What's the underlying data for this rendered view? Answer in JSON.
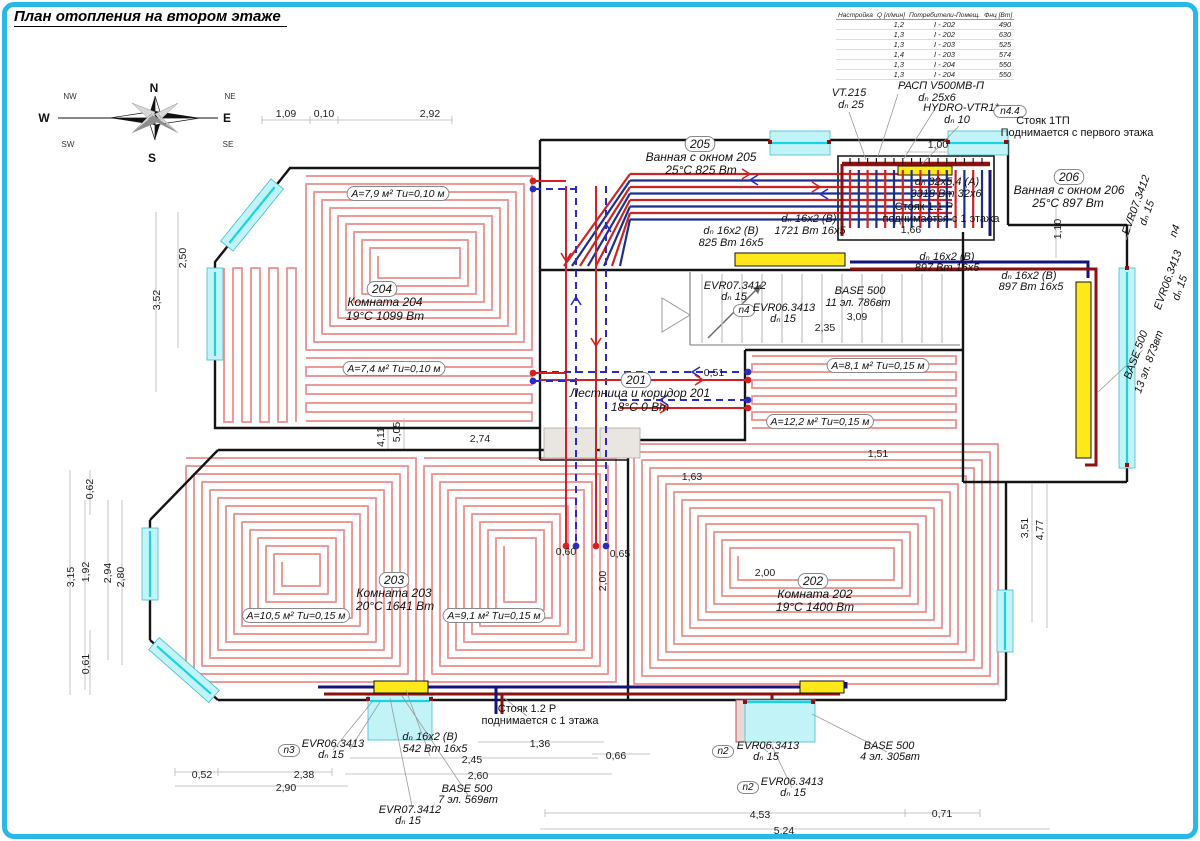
{
  "title": "План отопления на втором этаже",
  "compass": {
    "n": "N",
    "ne": "NE",
    "e": "E",
    "se": "SE",
    "s": "S",
    "sw": "SW",
    "w": "W",
    "nw": "NW"
  },
  "colors": {
    "frame": "#29b8ea",
    "loop": "#ef9a9a",
    "supply": "#d42020",
    "return": "#2b2bc0",
    "pipe_hot": "#8f1010",
    "pipe_cold": "#14147a",
    "window": "#c2f3f7",
    "radiator": "#ffe81a"
  },
  "table": {
    "headers": [
      "Настройка",
      "Q [л/мин]",
      "Потребители-Помещ.",
      "Фнц [Вт]"
    ],
    "rows": [
      [
        "",
        "1,2",
        "I - 202",
        "490"
      ],
      [
        "",
        "1,3",
        "I - 202",
        "630"
      ],
      [
        "",
        "1,3",
        "I - 203",
        "525"
      ],
      [
        "",
        "1,4",
        "I - 203",
        "574"
      ],
      [
        "",
        "1,3",
        "I - 204",
        "550"
      ],
      [
        "",
        "1,3",
        "I - 204",
        "550"
      ]
    ]
  },
  "rooms": [
    {
      "number": "204",
      "name": "Комната 204",
      "climate": "19°C 1099 Вт"
    },
    {
      "number": "205",
      "name": "Ванная с окном 205",
      "climate": "25°C 825 Вт"
    },
    {
      "number": "206",
      "name": "Ванная с окном 206",
      "climate": "25°C 897 Вт"
    },
    {
      "number": "201",
      "name": "Лестница и коридор 201",
      "climate": "18°C 0 Вт"
    },
    {
      "number": "202",
      "name": "Комната 202",
      "climate": "19°C 1400 Вт"
    },
    {
      "number": "203",
      "name": "Комната 203",
      "climate": "20°C 1641 Вт"
    }
  ],
  "plan": {
    "labels": [
      {
        "t": "1,09",
        "c": "d",
        "x": 286,
        "y": 117
      },
      {
        "t": "0,10",
        "c": "d",
        "x": 324,
        "y": 117
      },
      {
        "t": "2,92",
        "c": "d",
        "x": 430,
        "y": 117
      },
      {
        "t": "1,00",
        "c": "d",
        "x": 938,
        "y": 148
      },
      {
        "t": "2,74",
        "c": "d",
        "x": 480,
        "y": 442
      },
      {
        "t": "4,11",
        "c": "dr",
        "x": 384,
        "y": 437,
        "r": -90
      },
      {
        "t": "5,05",
        "c": "dr",
        "x": 400,
        "y": 432,
        "r": -90
      },
      {
        "t": "2,50",
        "c": "dr",
        "x": 186,
        "y": 258,
        "r": -90
      },
      {
        "t": "3,52",
        "c": "dr",
        "x": 160,
        "y": 300,
        "r": -90
      },
      {
        "t": "0,62",
        "c": "dr",
        "x": 93,
        "y": 489,
        "r": -90
      },
      {
        "t": "3,15",
        "c": "dr",
        "x": 74,
        "y": 577,
        "r": -90
      },
      {
        "t": "1,92",
        "c": "dr",
        "x": 89,
        "y": 572,
        "r": -90
      },
      {
        "t": "2,94",
        "c": "dr",
        "x": 111,
        "y": 573,
        "r": -90
      },
      {
        "t": "2,80",
        "c": "dr",
        "x": 124,
        "y": 577,
        "r": -90
      },
      {
        "t": "0,61",
        "c": "dr",
        "x": 89,
        "y": 664,
        "r": -90
      },
      {
        "t": "3,51",
        "c": "dr",
        "x": 1028,
        "y": 528,
        "r": -90
      },
      {
        "t": "4,77",
        "c": "dr",
        "x": 1043,
        "y": 530,
        "r": -90
      },
      {
        "t": "1,10",
        "c": "dr",
        "x": 1061,
        "y": 229,
        "r": -90
      },
      {
        "t": "1,66",
        "c": "d",
        "x": 911,
        "y": 233
      },
      {
        "t": "2,35",
        "c": "d",
        "x": 825,
        "y": 331
      },
      {
        "t": "3,09",
        "c": "d",
        "x": 857,
        "y": 320
      },
      {
        "t": "0,51",
        "c": "d",
        "x": 714,
        "y": 376
      },
      {
        "t": "1,63",
        "c": "d",
        "x": 692,
        "y": 480
      },
      {
        "t": "0,60",
        "c": "d",
        "x": 566,
        "y": 555
      },
      {
        "t": "0,65",
        "c": "d",
        "x": 620,
        "y": 557
      },
      {
        "t": "2,00",
        "c": "dr",
        "x": 606,
        "y": 581,
        "r": -90
      },
      {
        "t": "2,00",
        "c": "d",
        "x": 765,
        "y": 576
      },
      {
        "t": "1,51",
        "c": "d",
        "x": 878,
        "y": 457
      },
      {
        "t": "0,52",
        "c": "d",
        "x": 202,
        "y": 778
      },
      {
        "t": "2,38",
        "c": "d",
        "x": 304,
        "y": 778
      },
      {
        "t": "2,90",
        "c": "d",
        "x": 286,
        "y": 791
      },
      {
        "t": "1,36",
        "c": "d",
        "x": 540,
        "y": 747
      },
      {
        "t": "0,66",
        "c": "d",
        "x": 616,
        "y": 759
      },
      {
        "t": "2,45",
        "c": "d",
        "x": 472,
        "y": 763
      },
      {
        "t": "2,60",
        "c": "d",
        "x": 478,
        "y": 779
      },
      {
        "t": "4,53",
        "c": "d",
        "x": 760,
        "y": 818
      },
      {
        "t": "0,71",
        "c": "d",
        "x": 942,
        "y": 817
      },
      {
        "t": "5,24",
        "c": "d",
        "x": 784,
        "y": 834
      },
      {
        "t": "VT.215",
        "c": "l",
        "x": 849,
        "y": 96
      },
      {
        "t": "dₙ 25",
        "c": "l",
        "x": 851,
        "y": 108
      },
      {
        "t": "РАСП V500МВ-П",
        "c": "l",
        "x": 941,
        "y": 89
      },
      {
        "t": "dₙ 25x6",
        "c": "l",
        "x": 937,
        "y": 101
      },
      {
        "t": "HYDRO-VTR1*",
        "c": "l",
        "x": 961,
        "y": 111
      },
      {
        "t": "dₙ 10",
        "c": "l",
        "x": 957,
        "y": 123
      },
      {
        "t": "n4.4",
        "c": "n",
        "x": 1010,
        "y": 114,
        "b": 1
      },
      {
        "t": "Стояк 1ТП",
        "c": "s",
        "x": 1043,
        "y": 124
      },
      {
        "t": "Поднимается с первого этажа",
        "c": "s",
        "x": 1077,
        "y": 136
      },
      {
        "t": "dₙ 32x5,4 (А)",
        "c": "l",
        "x": 947,
        "y": 185
      },
      {
        "t": "3318 Вт 32x6",
        "c": "l",
        "x": 946,
        "y": 197
      },
      {
        "t": "Стояк 1.1 Р",
        "c": "s",
        "x": 924,
        "y": 210
      },
      {
        "t": "поднимается с 1 этажа",
        "c": "s",
        "x": 941,
        "y": 222
      },
      {
        "t": "dₙ 16x2 (В)",
        "c": "l",
        "x": 731,
        "y": 234
      },
      {
        "t": "825 Вт 16x5",
        "c": "l",
        "x": 731,
        "y": 246
      },
      {
        "t": "dₙ 16x2 (В)",
        "c": "l",
        "x": 809,
        "y": 222
      },
      {
        "t": "1721 Вт 16x5",
        "c": "l",
        "x": 810,
        "y": 234
      },
      {
        "t": "dₙ 16x2 (В)",
        "c": "l",
        "x": 947,
        "y": 260
      },
      {
        "t": "897 Вт 16x5",
        "c": "l",
        "x": 947,
        "y": 271
      },
      {
        "t": "dₙ 16x2 (В)",
        "c": "l",
        "x": 1029,
        "y": 279
      },
      {
        "t": "897 Вт 16x5",
        "c": "l",
        "x": 1031,
        "y": 290
      },
      {
        "t": "EVR07.3412",
        "c": "l",
        "x": 735,
        "y": 289
      },
      {
        "t": "dₙ 15",
        "c": "l",
        "x": 734,
        "y": 300
      },
      {
        "t": "n4",
        "c": "n",
        "x": 744,
        "y": 313,
        "b": 1
      },
      {
        "t": "EVR06.3413",
        "c": "l",
        "x": 784,
        "y": 311
      },
      {
        "t": "dₙ 15",
        "c": "l",
        "x": 783,
        "y": 322
      },
      {
        "t": "BASE 500",
        "c": "l",
        "x": 860,
        "y": 294
      },
      {
        "t": "11 эл. 786вт",
        "c": "l",
        "x": 858,
        "y": 306
      },
      {
        "t": "205",
        "c": "rn",
        "x": 700,
        "y": 148,
        "b": 1
      },
      {
        "t": "Ванная с окном 205",
        "c": "r",
        "x": 701,
        "y": 161
      },
      {
        "t": "25°C 825 Вт",
        "c": "r",
        "x": 701,
        "y": 174
      },
      {
        "t": "206",
        "c": "rn",
        "x": 1069,
        "y": 181,
        "b": 1
      },
      {
        "t": "Ванная с окном 206",
        "c": "r",
        "x": 1069,
        "y": 194
      },
      {
        "t": "25°C 897 Вт",
        "c": "r",
        "x": 1068,
        "y": 207
      },
      {
        "t": "204",
        "c": "rn",
        "x": 382,
        "y": 293,
        "b": 1
      },
      {
        "t": "Комната 204",
        "c": "r",
        "x": 385,
        "y": 306
      },
      {
        "t": "19°C 1099 Вт",
        "c": "r",
        "x": 385,
        "y": 320
      },
      {
        "t": "201",
        "c": "rn",
        "x": 636,
        "y": 384,
        "b": 1
      },
      {
        "t": "Лестница и коридор 201",
        "c": "r",
        "x": 640,
        "y": 397
      },
      {
        "t": "18°C 0 Вт",
        "c": "r",
        "x": 640,
        "y": 411
      },
      {
        "t": "202",
        "c": "rn",
        "x": 813,
        "y": 585,
        "b": 1
      },
      {
        "t": "Комната 202",
        "c": "r",
        "x": 815,
        "y": 598
      },
      {
        "t": "19°C 1400 Вт",
        "c": "r",
        "x": 815,
        "y": 611
      },
      {
        "t": "203",
        "c": "rn",
        "x": 394,
        "y": 584,
        "b": 1
      },
      {
        "t": "Комната 203",
        "c": "r",
        "x": 394,
        "y": 597
      },
      {
        "t": "20°C 1641 Вт",
        "c": "r",
        "x": 395,
        "y": 610
      },
      {
        "t": "А=7,9 м² Tи=0,10 м",
        "c": "a",
        "x": 398,
        "y": 197,
        "b": 1
      },
      {
        "t": "А=7,4 м² Tи=0,10 м",
        "c": "a",
        "x": 394,
        "y": 372,
        "b": 1
      },
      {
        "t": "А=10,5 м² Tи=0,15 м",
        "c": "a",
        "x": 296,
        "y": 619,
        "b": 1
      },
      {
        "t": "А=9,1 м² Tи=0,15 м",
        "c": "a",
        "x": 494,
        "y": 619,
        "b": 1
      },
      {
        "t": "А=8,1 м² Tи=0,15 м",
        "c": "a",
        "x": 878,
        "y": 369,
        "b": 1
      },
      {
        "t": "А=12,2 м² Tи=0,15 м",
        "c": "a",
        "x": 820,
        "y": 425,
        "b": 1
      },
      {
        "t": "Стояк 1.2 Р",
        "c": "s",
        "x": 527,
        "y": 712
      },
      {
        "t": "поднимается с 1 этажа",
        "c": "s",
        "x": 540,
        "y": 724
      },
      {
        "t": "dₙ 16x2 (В)",
        "c": "l",
        "x": 430,
        "y": 740
      },
      {
        "t": "542 Вт 16x5",
        "c": "l",
        "x": 435,
        "y": 752
      },
      {
        "t": "n3",
        "c": "n",
        "x": 289,
        "y": 753,
        "b": 1
      },
      {
        "t": "EVR06.3413",
        "c": "l",
        "x": 333,
        "y": 747
      },
      {
        "t": "dₙ 15",
        "c": "l",
        "x": 331,
        "y": 758
      },
      {
        "t": "BASE 500",
        "c": "l",
        "x": 467,
        "y": 792
      },
      {
        "t": "7 эл. 569вт",
        "c": "l",
        "x": 468,
        "y": 803
      },
      {
        "t": "EVR07.3412",
        "c": "l",
        "x": 410,
        "y": 813
      },
      {
        "t": "dₙ 15",
        "c": "l",
        "x": 408,
        "y": 824
      },
      {
        "t": "n2",
        "c": "n",
        "x": 723,
        "y": 754,
        "b": 1
      },
      {
        "t": "EVR06.3413",
        "c": "l",
        "x": 768,
        "y": 749
      },
      {
        "t": "dₙ 15",
        "c": "l",
        "x": 766,
        "y": 760
      },
      {
        "t": "BASE 500",
        "c": "l",
        "x": 889,
        "y": 749
      },
      {
        "t": "4 эл. 305вт",
        "c": "l",
        "x": 890,
        "y": 760
      },
      {
        "t": "n2",
        "c": "n",
        "x": 748,
        "y": 790,
        "b": 1
      },
      {
        "t": "EVR06.3413",
        "c": "l",
        "x": 792,
        "y": 785
      },
      {
        "t": "dₙ 15",
        "c": "l",
        "x": 793,
        "y": 796
      },
      {
        "t": "EVR07.3412",
        "c": "lr",
        "x": 1139,
        "y": 206,
        "r": -70
      },
      {
        "t": "dₙ 15",
        "c": "lr",
        "x": 1150,
        "y": 214,
        "r": -70
      },
      {
        "t": "n4",
        "c": "lr",
        "x": 1178,
        "y": 232,
        "r": -70
      },
      {
        "t": "EVR06.3413",
        "c": "lr",
        "x": 1171,
        "y": 281,
        "r": -70
      },
      {
        "t": "dₙ 15",
        "c": "lr",
        "x": 1183,
        "y": 289,
        "r": -70
      },
      {
        "t": "BASE 500",
        "c": "lr",
        "x": 1139,
        "y": 356,
        "r": -70
      },
      {
        "t": "13 эл. 873вт",
        "c": "lr",
        "x": 1152,
        "y": 363,
        "r": -70
      }
    ]
  }
}
